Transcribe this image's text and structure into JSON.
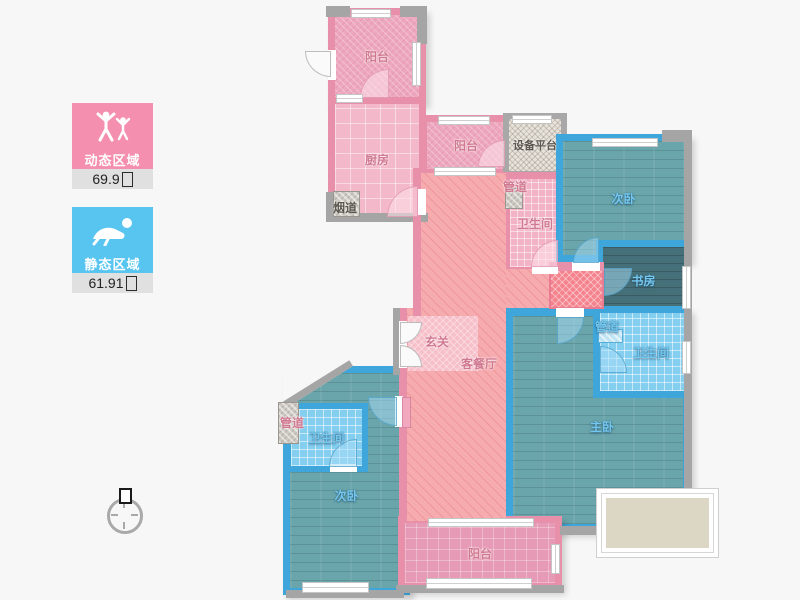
{
  "legend": {
    "dynamic": {
      "label": "动态区域",
      "area": "69.9",
      "unit": "㎡",
      "color": "#F48FB0"
    },
    "static": {
      "label": "静态区域",
      "area": "61.91",
      "unit": "㎡",
      "color": "#58C5F0"
    }
  },
  "rooms": [
    {
      "id": "balcony-north",
      "label": "阳台"
    },
    {
      "id": "kitchen",
      "label": "厨房"
    },
    {
      "id": "flue",
      "label": "烟道"
    },
    {
      "id": "balcony-mid",
      "label": "阳台"
    },
    {
      "id": "equipment-platform",
      "label": "设备平台"
    },
    {
      "id": "pipe-north",
      "label": "管道"
    },
    {
      "id": "bath-north",
      "label": "卫生间"
    },
    {
      "id": "bedroom-northeast",
      "label": "次卧"
    },
    {
      "id": "study",
      "label": "书房"
    },
    {
      "id": "pipe-east",
      "label": "管道"
    },
    {
      "id": "bath-east",
      "label": "卫生间"
    },
    {
      "id": "master-bedroom",
      "label": "主卧"
    },
    {
      "id": "foyer",
      "label": "玄关"
    },
    {
      "id": "living-dining",
      "label": "客餐厅"
    },
    {
      "id": "pipe-west",
      "label": "管道"
    },
    {
      "id": "bath-west",
      "label": "卫生间"
    },
    {
      "id": "bedroom-southwest",
      "label": "次卧"
    },
    {
      "id": "balcony-south",
      "label": "阳台"
    }
  ],
  "colors": {
    "wall_pink": "#E88FA9",
    "wall_blue": "#3FA6DB",
    "wall_gray": "#A5A5A5",
    "living_fill": "#F6ABAE",
    "bedroom_fill": "#69A5AB",
    "background": "#F7F7F7"
  }
}
